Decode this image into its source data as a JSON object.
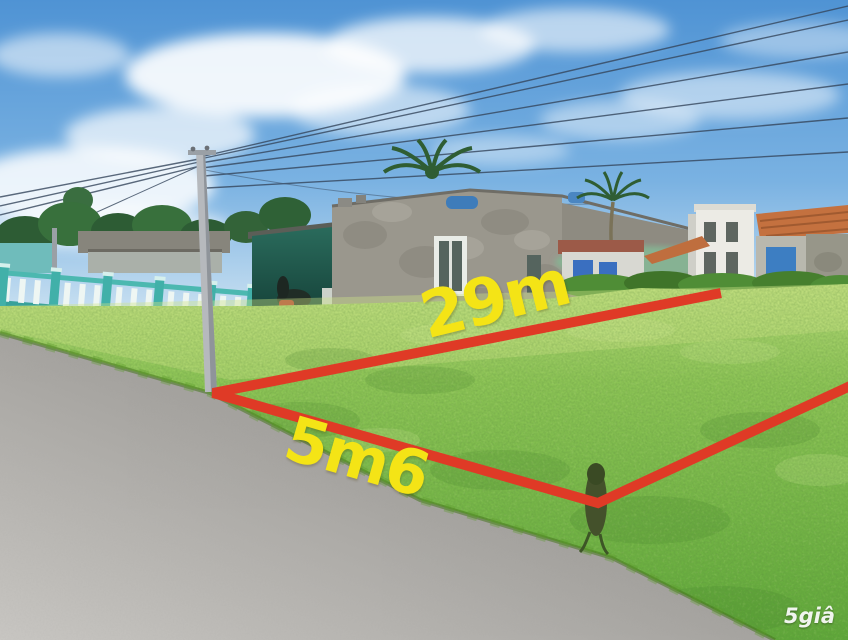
{
  "scene": {
    "kind": "real-estate-listing-photo",
    "description": "Vacant grassy land plot beside a concrete road, boundary of the plot hand-drawn in red over the photo, weathered concrete houses, teal fence, utility pole and power lines under a blue sky with clouds and palm trees"
  },
  "overlay": {
    "depth_label": "29m",
    "frontage_label": "5m6",
    "boundary_color": "#df3a26",
    "label_color": "#f4e416"
  },
  "watermark": {
    "text": "5giâ"
  }
}
